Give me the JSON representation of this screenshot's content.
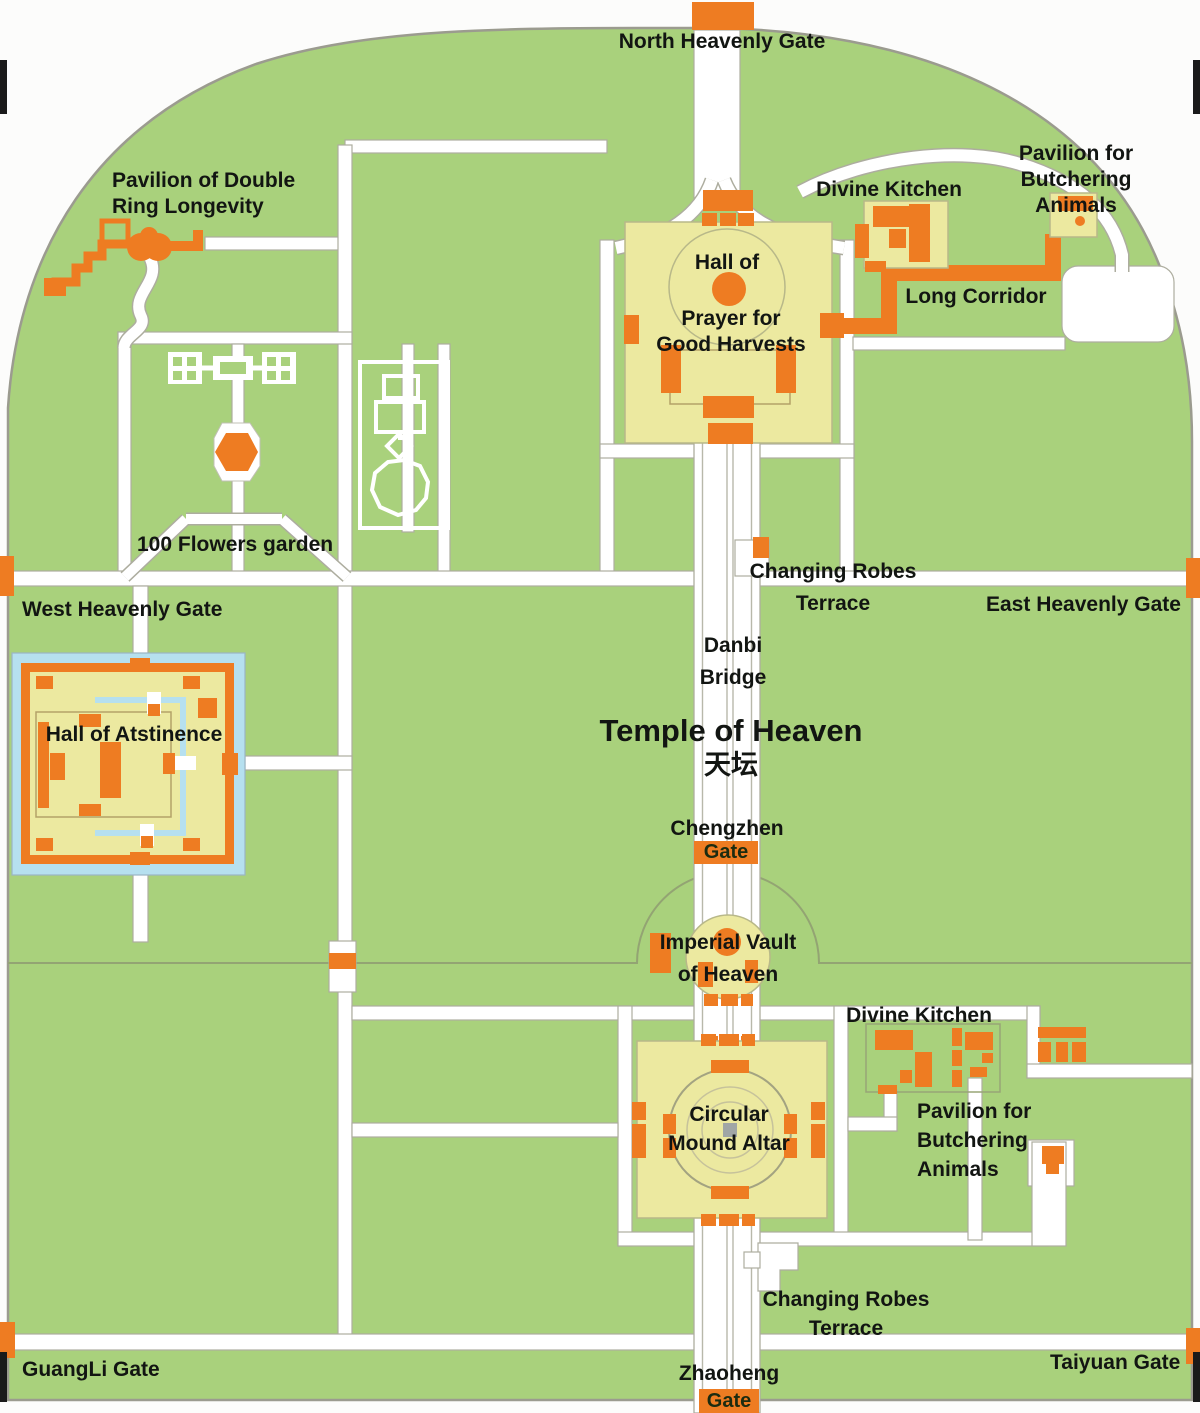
{
  "map": {
    "title": "Temple of Heaven",
    "title_zh": "天坛"
  },
  "colors": {
    "park_green": "#a9d17c",
    "building_orange": "#ee7c22",
    "complex_yellow": "#ece9a0",
    "path_white": "#ffffff",
    "moat_blue": "#b6e0ef",
    "boundary_gray": "#9b9b8f",
    "label_text": "#121512"
  },
  "labels": {
    "north_heavenly_gate": "North Heavenly Gate",
    "pavilion_double_ring": "Pavilion of Double\nRing Longevity",
    "divine_kitchen_north": "Divine Kitchen",
    "pavilion_butchering_north": "Pavilion for\nButchering Animals",
    "long_corridor": "Long Corridor",
    "hall_of_prayer_line1": "Hall of",
    "hall_of_prayer_line2": "Prayer for\nGood Harvests",
    "flowers_garden": "100 Flowers garden",
    "west_heavenly_gate": "West Heavenly Gate",
    "changing_robes_mid": "Changing Robes\nTerrace",
    "east_heavenly_gate": "East Heavenly Gate",
    "danbi_bridge": "Danbi\nBridge",
    "hall_of_abstinence": "Hall of Atstinence",
    "chengzhen_name": "Chengzhen",
    "chengzhen_gate_chip": "Gate",
    "imperial_vault": "Imperial Vault\nof Heaven",
    "divine_kitchen_south": "Divine Kitchen",
    "circular_mound": "Circular\nMound Altar",
    "pavilion_butchering_south": "Pavilion for\nButchering\nAnimals",
    "changing_robes_south": "Changing Robes\nTerrace",
    "guangli_gate": "GuangLi Gate",
    "zhaoheng_name": "Zhaoheng",
    "zhaoheng_gate_chip": "Gate",
    "taiyuan_gate": "Taiyuan Gate"
  }
}
